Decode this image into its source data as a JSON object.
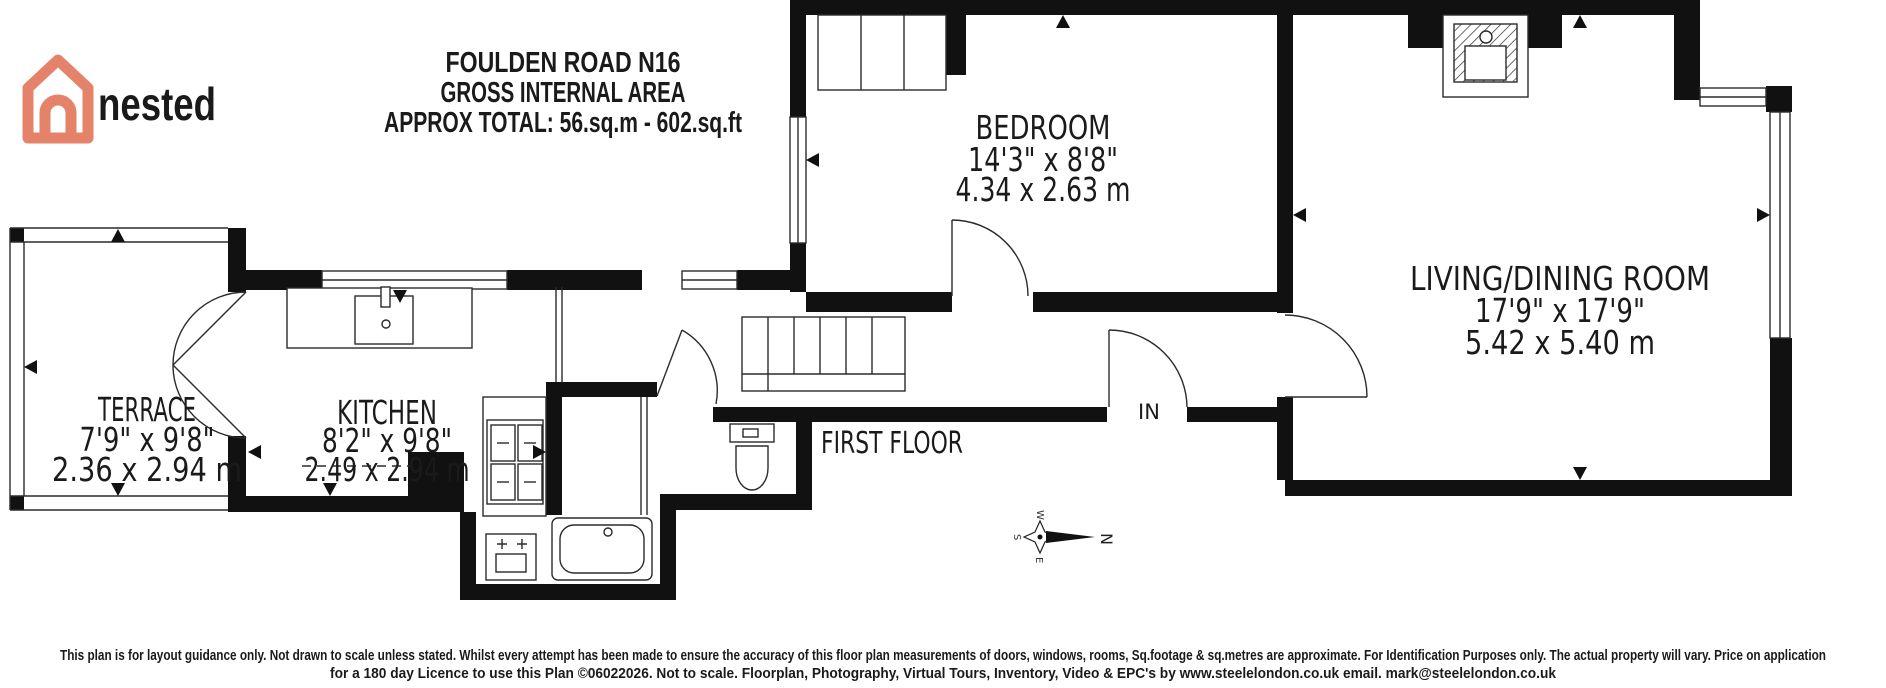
{
  "brand": {
    "name": "nested",
    "logo_icon": "nested-house-logo",
    "logo_color": "#E5826A",
    "wordmark_color": "#3E4A59"
  },
  "title": {
    "line1": "FOULDEN ROAD N16",
    "line2": "GROSS INTERNAL AREA",
    "line3": "APPROX TOTAL: 56.sq.m - 602.sq.ft"
  },
  "plan": {
    "floor_label": "FIRST FLOOR",
    "entrance_label": "IN",
    "wall_color": "#111111",
    "compass": {
      "north": "N",
      "south": "S",
      "east": "E",
      "west": "W"
    },
    "rooms": [
      {
        "id": "bedroom",
        "name": "BEDROOM",
        "imperial": "14'3\" x 8'8\"",
        "metric": "4.34 x 2.63 m"
      },
      {
        "id": "living-dining",
        "name": "LIVING/DINING ROOM",
        "imperial": "17'9\" x 17'9\"",
        "metric": "5.42 x 5.40 m"
      },
      {
        "id": "terrace",
        "name": "TERRACE",
        "imperial": "7'9\" x 9'8\"",
        "metric": "2.36 x 2.94 m"
      },
      {
        "id": "kitchen",
        "name": "KITCHEN",
        "imperial": "8'2\" x 9'8\"",
        "metric": "2.49 x 2.94 m"
      }
    ]
  },
  "footer": {
    "line1": "This plan is for layout guidance only. Not drawn to scale unless stated. Whilst every attempt has been made to ensure the accuracy of this floor plan measurements of doors, windows, rooms, Sq.footage & sq.metres are approximate. For Identification Purposes only. The actual property will vary. Price on application",
    "line2": "for a 180 day Licence to use this Plan ©06022026. Not to scale. Floorplan, Photography, Virtual Tours, Inventory, Video & EPC's by www.steelelondon.co.uk  email. mark@steelelondon.co.uk"
  }
}
